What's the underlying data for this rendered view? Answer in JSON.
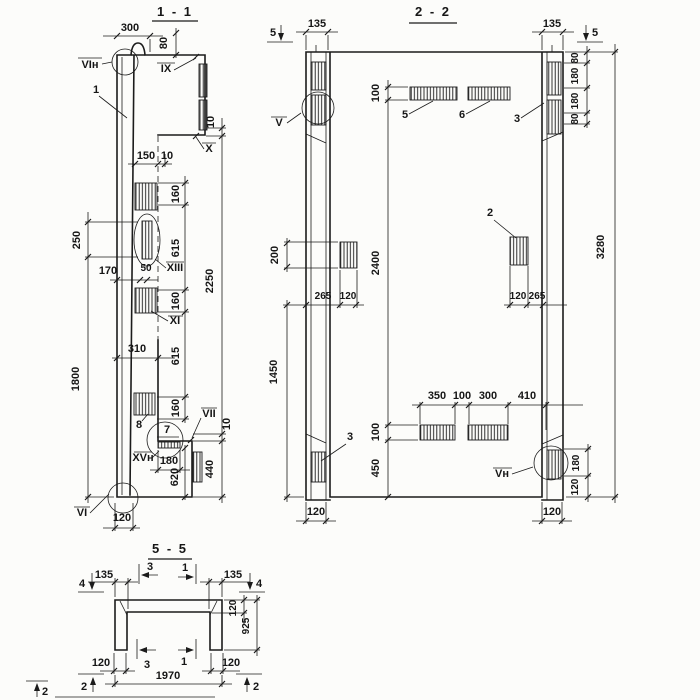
{
  "s11": {
    "title": "1 - 1",
    "dims": {
      "d300": "300",
      "d80": "80",
      "d150": "150",
      "d10w": "10",
      "d250": "250",
      "d170": "170",
      "d50": "50",
      "d310": "310",
      "d1800": "1800",
      "c160a": "160",
      "c615a": "615",
      "c160b": "160",
      "c615b": "615",
      "c160c": "160",
      "d10t": "10",
      "d2250": "2250",
      "d10b": "10",
      "d440": "440",
      "d180": "180",
      "d620": "620",
      "d120": "120"
    },
    "callouts": {
      "vin": "VIн",
      "p1": "1",
      "ix": "IX",
      "x": "X",
      "xiii": "XIII",
      "xi": "XI",
      "p8": "8",
      "p7": "7",
      "vii": "VII",
      "xvn": "XVн",
      "vi": "VI"
    }
  },
  "s22": {
    "title": "2 - 2",
    "markers": {
      "left5": "5",
      "right5": "5"
    },
    "dims": {
      "l135": "135",
      "r135": "135",
      "rc80a": "80",
      "rc180a": "180",
      "rc180b": "180",
      "rc80b": "80",
      "t100": "100",
      "m2400": "2400",
      "b100": "100",
      "b450": "450",
      "m200": "200",
      "l1450": "1450",
      "r3280": "3280",
      "lp265": "265",
      "lp120": "120",
      "rp120": "120",
      "rp265": "265",
      "bc350": "350",
      "bc100": "100",
      "bc300": "300",
      "bc410": "410",
      "br180": "180",
      "br120": "120",
      "bot120l": "120",
      "bot120r": "120"
    },
    "callouts": {
      "v": "V",
      "p5": "5",
      "p6": "6",
      "p3a": "3",
      "p2": "2",
      "p3b": "3",
      "vn": "Vн"
    }
  },
  "s55": {
    "title": "5 - 5",
    "markers": {
      "l4": "4",
      "r4": "4",
      "t3": "3",
      "t1": "1",
      "b3": "3",
      "b1": "1",
      "bl2": "2",
      "br2": "2",
      "c2": "2"
    },
    "dims": {
      "l135": "135",
      "r135": "135",
      "r120": "120",
      "r925": "925",
      "b120l": "120",
      "b120r": "120",
      "b1970": "1970"
    }
  }
}
